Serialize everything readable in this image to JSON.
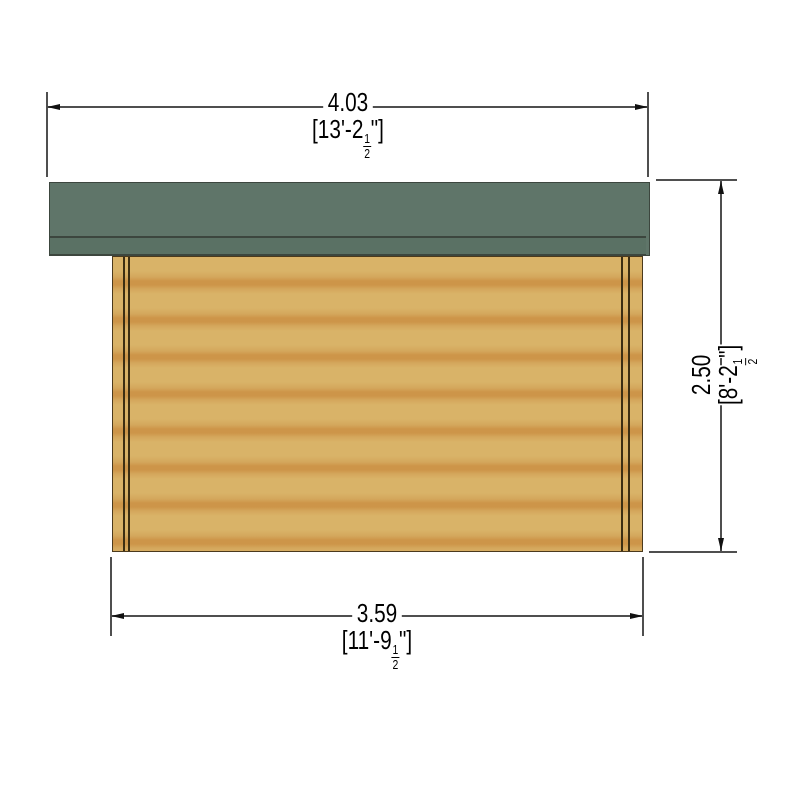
{
  "dimensions": {
    "roof_width": {
      "metric": "4.03",
      "imperial_open": "[13'-2",
      "fraction_numerator": "1",
      "fraction_denominator": "2",
      "imperial_close": "\"]"
    },
    "wall_width": {
      "metric": "3.59",
      "imperial_open": "[11'-9",
      "fraction_numerator": "1",
      "fraction_denominator": "2",
      "imperial_close": "\"]"
    },
    "wall_height": {
      "metric": "2.50",
      "imperial_open": "[8'-2",
      "fraction_numerator": "1",
      "fraction_denominator": "2",
      "imperial_close": "\"]"
    }
  },
  "colors": {
    "roof_main": "#5f7569",
    "roof_fascia": "#5a7164",
    "roof_outline": "#3c463e",
    "wood_light": "#d9b368",
    "wood_mid": "#d4a75c",
    "wood_dark": "#cd9549",
    "wood_outline": "#4b3a1d",
    "joint_line": "#3c2e12",
    "dim_line": "#4f4f4f",
    "arrow": "#111111",
    "text": "#000000"
  }
}
